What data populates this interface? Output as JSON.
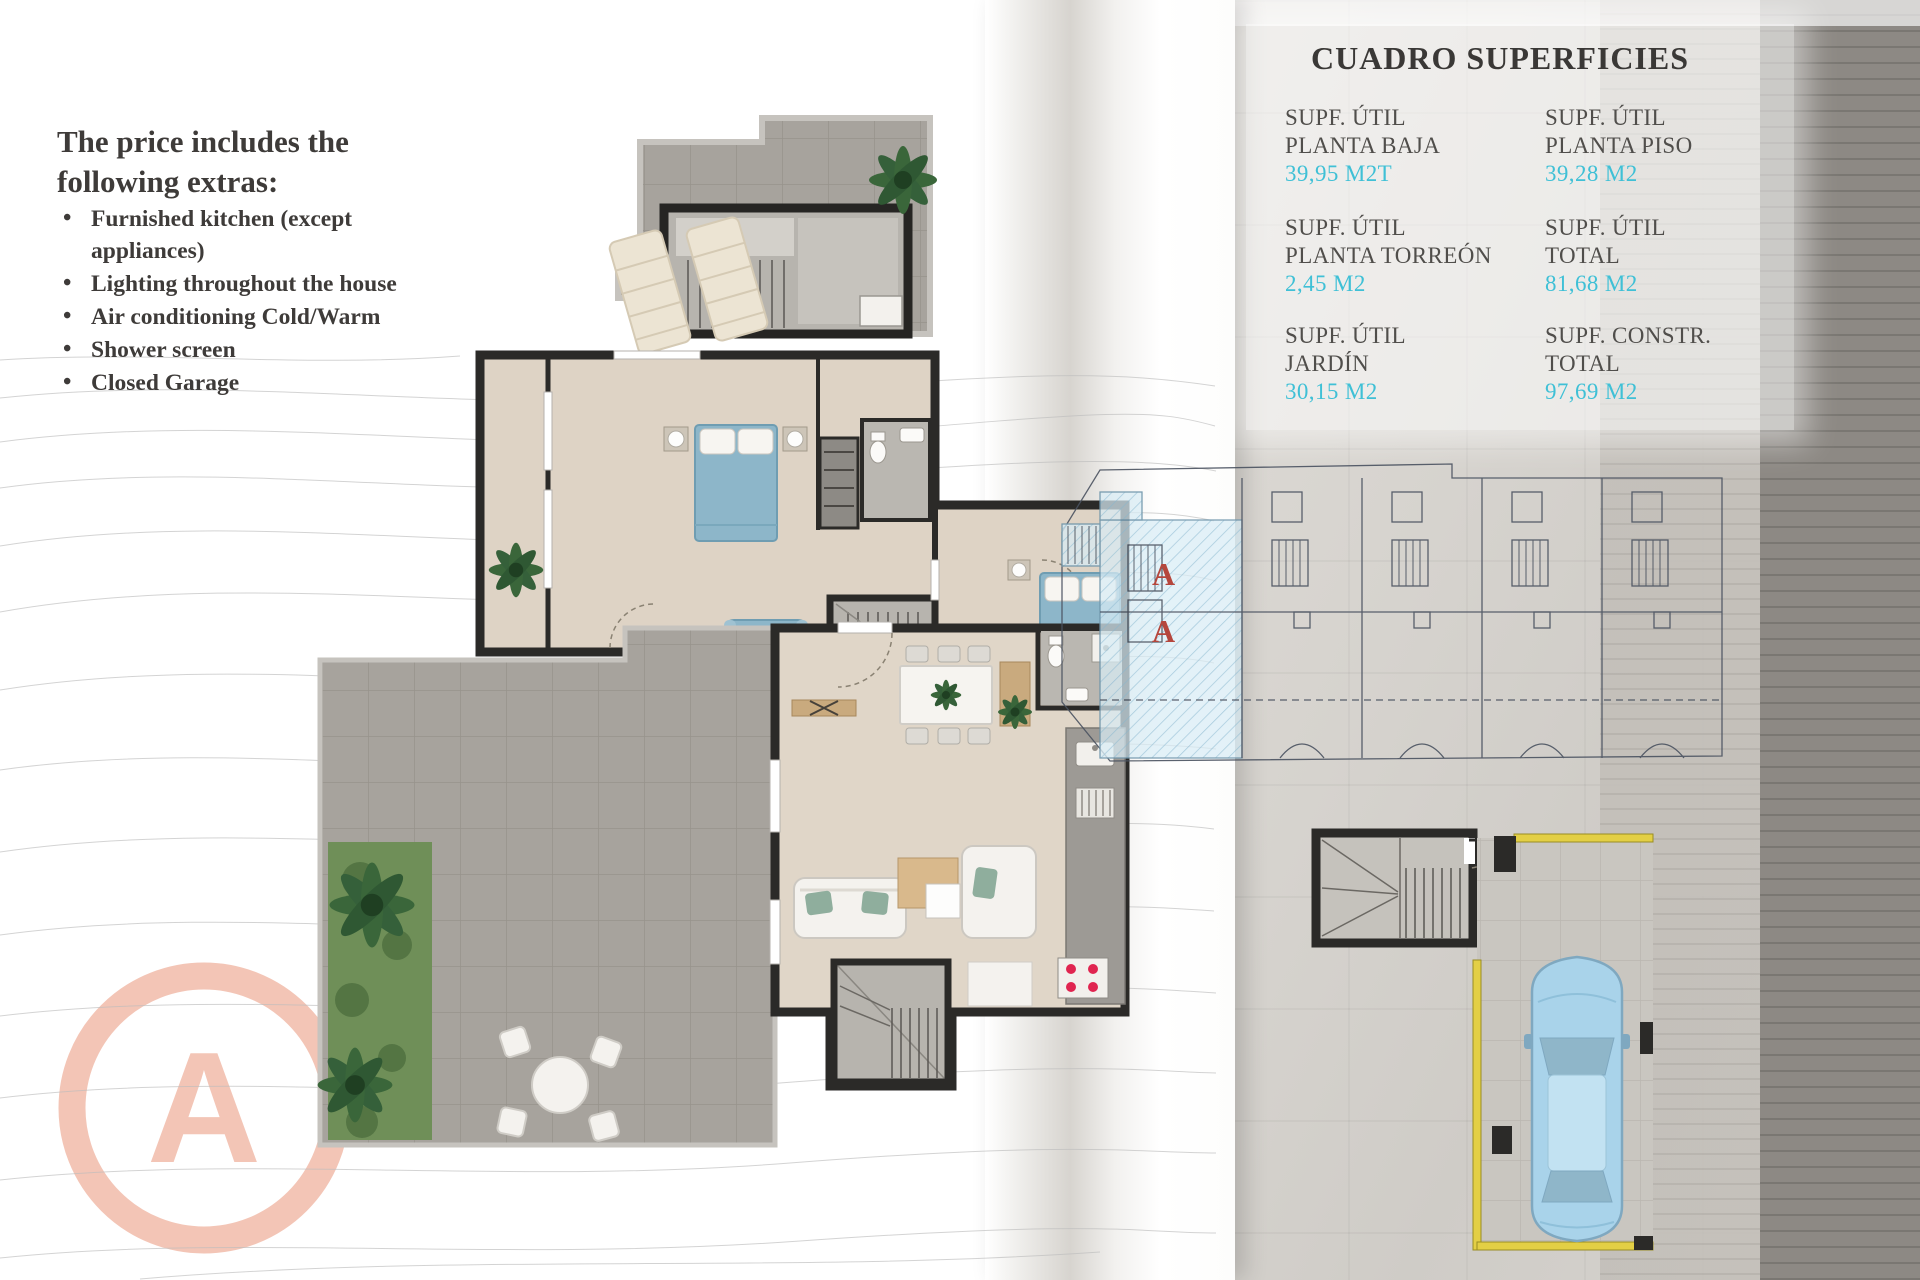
{
  "left_panel": {
    "heading_line1": "The price includes the",
    "heading_line2": "following extras:",
    "bullets": [
      "Furnished kitchen (except appliances)",
      "Lighting throughout the house",
      "Air conditioning Cold/Warm",
      "Shower screen",
      "Closed Garage"
    ]
  },
  "surfaces": {
    "title": "CUADRO SUPERFICIES",
    "value_color": "#3fc0d6",
    "cells": [
      {
        "line1": "SUPF. ÚTIL",
        "line2": "PLANTA BAJA",
        "value": "39,95 M2T"
      },
      {
        "line1": "SUPF. ÚTIL",
        "line2": "PLANTA PISO",
        "value": "39,28 M2"
      },
      {
        "line1": "SUPF. ÚTIL",
        "line2": "PLANTA TORREÓN",
        "value": "2,45 M2"
      },
      {
        "line1": "SUPF. ÚTIL",
        "line2": "TOTAL",
        "value": "81,68 M2"
      },
      {
        "line1": "SUPF. ÚTIL",
        "line2": "JARDÍN",
        "value": "30,15 M2"
      },
      {
        "line1": "SUPF. CONSTR.",
        "line2": "TOTAL",
        "value": "97,69 M2"
      }
    ]
  },
  "site_plan": {
    "unit_label": "A",
    "unit_label_color": "#b5463c"
  },
  "logo": {
    "letter": "A",
    "color": "#f3c5b6"
  }
}
